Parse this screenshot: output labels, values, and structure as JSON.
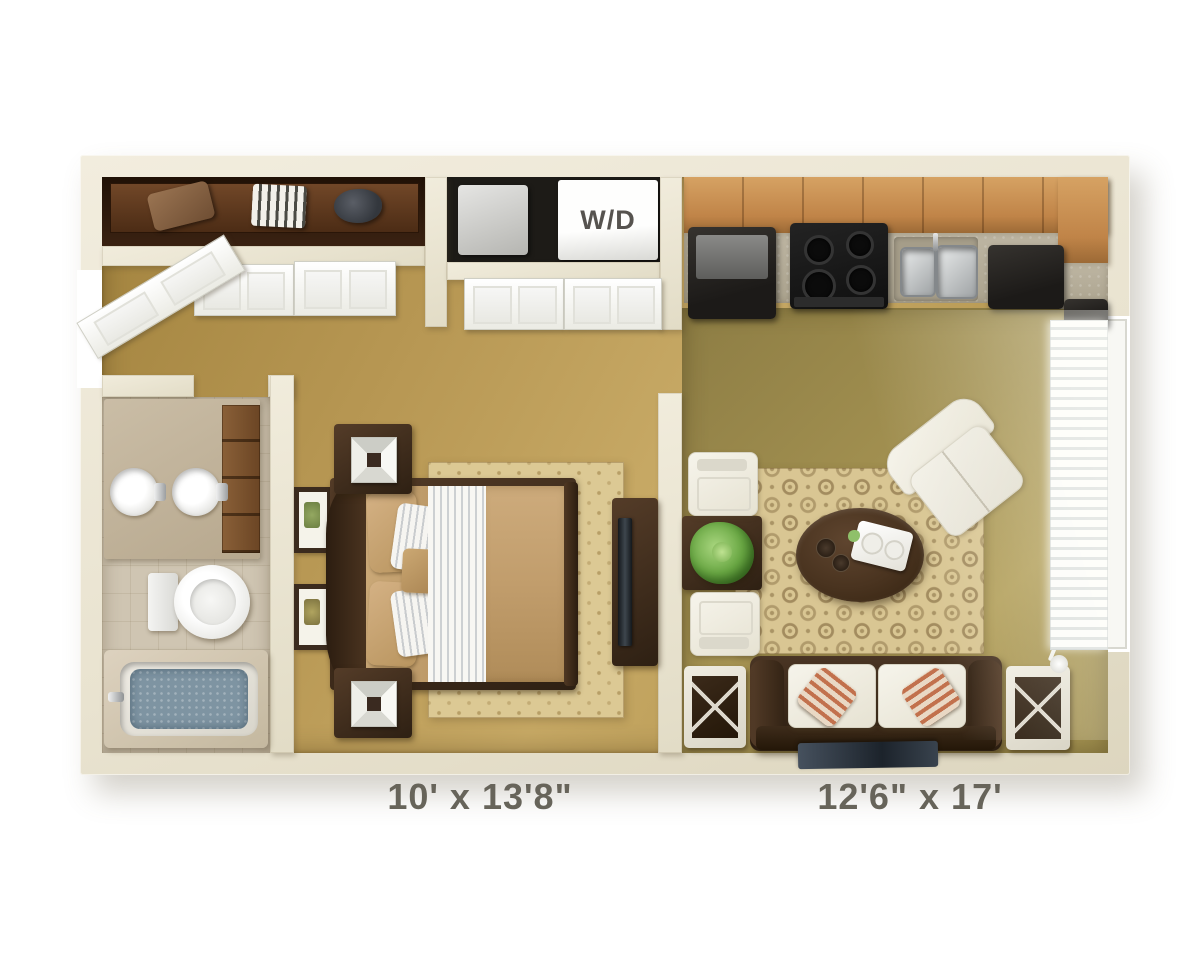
{
  "labels": {
    "washer_dryer": "W/D",
    "left_room_dimensions": "10' x 13'8\"",
    "right_room_dimensions": "12'6\" x 17'"
  },
  "palette": {
    "background": "#FFFFFF",
    "walls": "#EBE5D2",
    "carpet_gold": "#B5954F",
    "living_floor_olive": "#9C8B4C",
    "bathroom_tile": "#CFC5B2",
    "cabinet_wood": "#C9955A",
    "counter_gray": "#B2AB98",
    "furniture_brown": "#3F2D1E",
    "rug_cream": "#DBC893",
    "upholstery_white": "#F2EFE6",
    "tub_water_blue": "#8296A3",
    "plant_green": "#6FAE4E",
    "label_text": "#67645A"
  }
}
